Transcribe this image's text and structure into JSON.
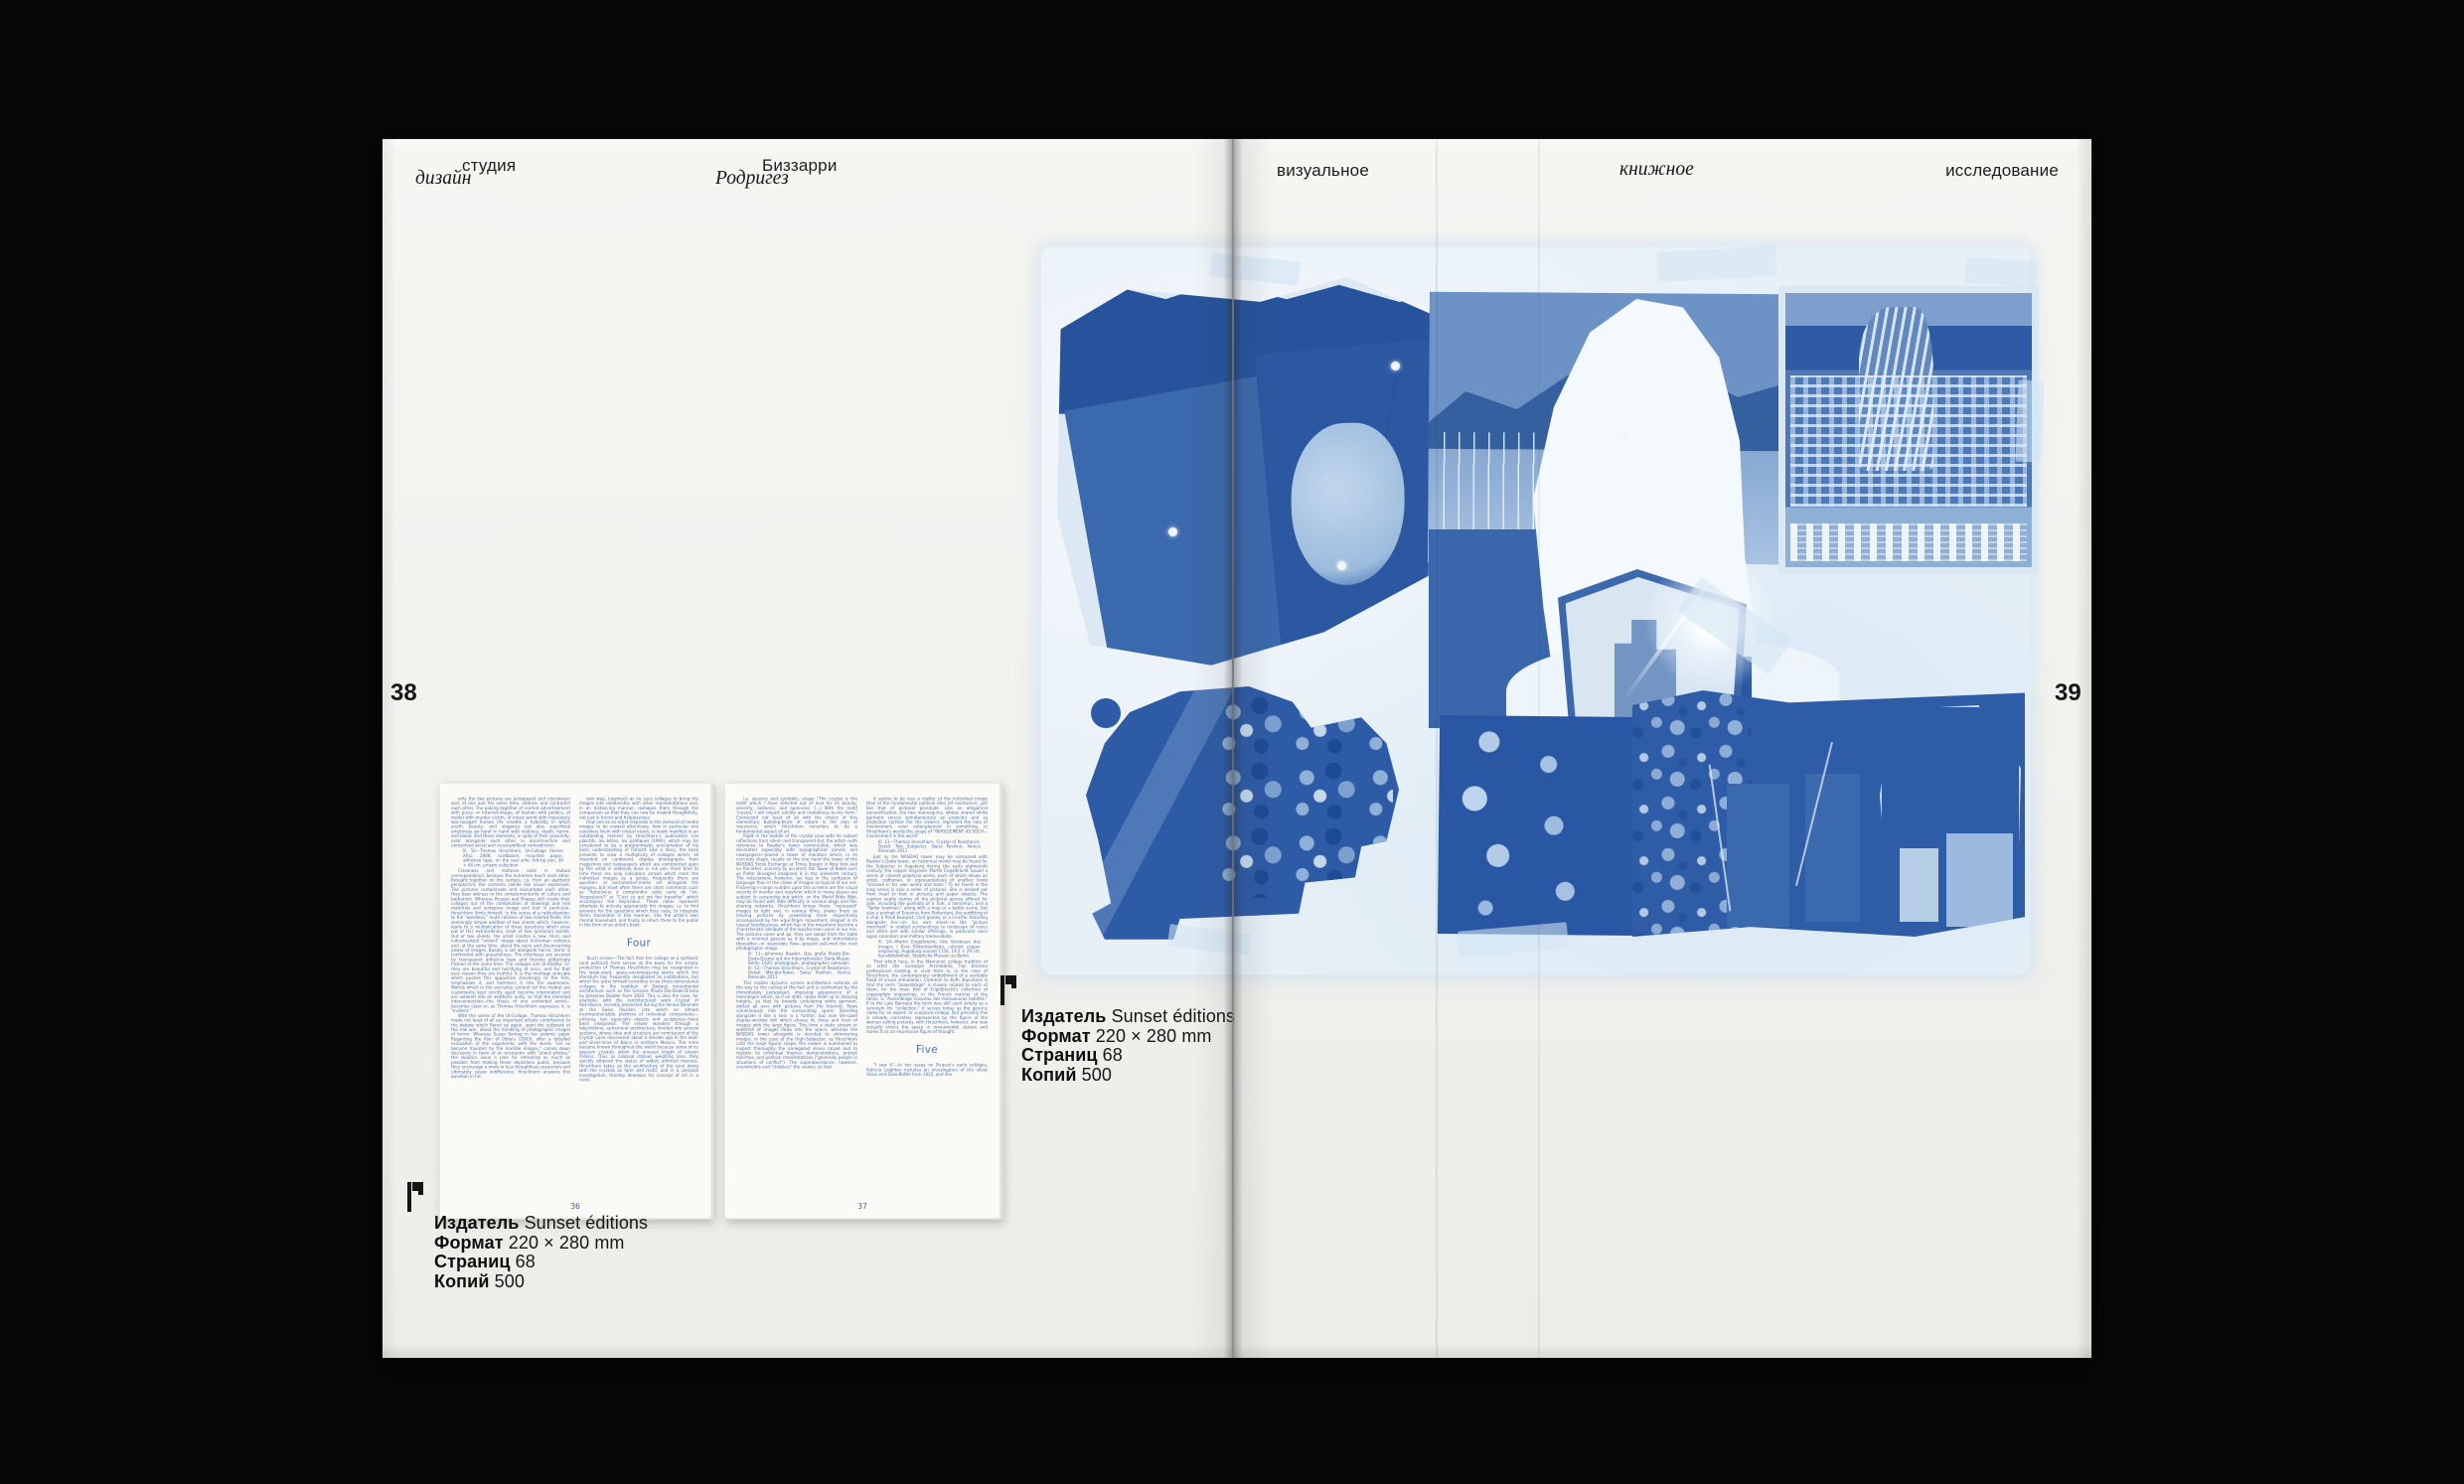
{
  "colors": {
    "background": "#070707",
    "paper": "#f2f1ee",
    "cyanotype_mid": "#3f6cac",
    "cyanotype_dark": "#2a57a3",
    "cyanotype_pale": "#e7f0f7",
    "mini_text_blue": "#4b70a9"
  },
  "icons": {
    "colophon_mark": "flag-pennant"
  },
  "left_header": {
    "studio_word": "студия",
    "design_word": "дизайн",
    "name_word1": "Биззарри",
    "name_word2": "Родригез"
  },
  "right_header": {
    "word1": "визуальное",
    "word2": "книжное",
    "word3": "исследование"
  },
  "page_numbers": {
    "left": "38",
    "right": "39"
  },
  "colophon": {
    "lines": [
      {
        "label": "Издатель",
        "value": "Sunset éditions"
      },
      {
        "label": "Формат",
        "value": "220 × 280 mm"
      },
      {
        "label": "Страниц",
        "value": "68"
      },
      {
        "label": "Копий",
        "value": "500"
      }
    ]
  },
  "mini_pages": [
    {
      "number": "36",
      "col1": [
        {
          "type": "para",
          "text": "only the two pictures are juxtaposed and interwoven and, at one and the same time, address and contradict each other. The poking together of current advertisement with press- or Internet-image, of fashion with politics, of model with murder victim, of intact world with hopelessly war-ravaged human life creates a hybridity in which youth, beauty, and elegance but also superficial emptiness go hand in hand with violence, death, horror, and blood, and these elements, in spite of their proximity, exist alongside each other in disconnection and unresolved social and visual-political contradiction."
        },
        {
          "type": "caption",
          "text": "Ill. 10—Thomas Hirschhorn, Ut-Collage (Series XXL), 2008, cardboard, mounted paper, adhesive tape, on the rear side: felt-tip pen, 30 × 44 cm, private collection"
        },
        {
          "type": "para",
          "text": "Closeness and distance exist in mutual correspondence, because the extremes touch each other. Brought together on the surface, i.e. from an aesthetic perspective, the contents collide like visual explosives. The pictures contaminate and exacerbate each other, they bear witness to the complementarity of culture and barbarism. Whereas Picasso and Braque still create their collages out of the combination of drawings and real materials and juxtapose image and text in particular, Hirschhorn limits himself, in the sense of a radicalization, to the \"wordless,\" mute collision of two colored fields, the seemingly simple addition of two sheets which, however, leads to a multiplication of those questions which arise out of this extraordinary clash of two (pictorial) worlds. Out of two sheets, the artist creates a new, third, and individualized \"violent\" image about (in)human violence and, at the same time, about the eerie and disconcerting power of images. Beauty is set alongside horror, terror is confronted with gracefulness. The interfaces are secured by transparent adhesive tape and thereby glitteringly framed at the same time. The collages aim at totality: i.e. they are beautiful and horrifying at once, and for that very reason they are truthful. It is the montage principle which pushes this opposition shockingly to the fore, emphasizes it, and hammers it into the awareness. Worlds which in the everyday context (of the media) are customarily kept strictly apart become interrelated and are ushered into an aesthetic unity, so that the intended interconnection—the thesis of one undivided world—becomes clear or, as Thomas Hirschhorn expresses it, is \"evident.\""
        },
        {
          "type": "para",
          "text": "With the series of the Ut-Collage, Thomas Hirschhorn made not least of all an important artistic contribution to the debate which flared up again, upon the outbreak of the Irak war, about the handling of photographic images of horror. Whereas Susan Sontag in her polemic paper Regarding the Pain of Others (2003), after a detailed evaluation of the arguments, with the words \"Let us become haunted by the horrible images,\" comes down decisively in favor of an encounter with \"shock photos,\" the skeptics issue a plea for refraining as much as possible from making these depictions public, because they encourage a more or less thoughtless voyeurism and ultimately cause indifference. Hirschhorn answers this question in his"
        }
      ],
      "col2": [
        {
          "type": "para",
          "text": "own way, inasmuch as he uses collages to bring the images into relationship with other representations and, in an distancing manner, reshapes them through the comparison so that they can now be viewed thoughtfully, not just in horror and helplessness."
        },
        {
          "type": "para",
          "text": "How one as an artist responds to the demand of media images to be viewed attentively, how in particular one considers them with critical vision, is made manifest in an outstanding manner by Hirschhorn's publication Les plaintifs, les bêtes, les politiques (1995), which may be considered to be a programmatic proclamation of his basic understanding of himself. Like a diary, the book presents to view a multiplicity of collages which, all mounted on cardboard, display photographs from magazines and newspapers which are commented upon by the artist in addenda done in ink pen. From time to time there are only indicatory arrows which mark the individual images as a group, frequently there are question- or exclamation-marks set alongside the margins, but most often there are short comments such as \"Autorisé-je à comprendre cette carte de l'ex-Yougoslavie?\" or \"C'est ce qui me fait travailler\" which accompany the depictions. These notes represent attempts to actively appropriate the images, i.e. to find answers for the questions which they raise, to integrate them, translated in this manner, into the artist's own mental household, and finally to return them to the public in the form of an artist's book."
        },
        {
          "type": "heading",
          "text": "Four"
        },
        {
          "type": "para",
          "text": "Touch screen—The fact that the collage as a symbolic (and political) form serves as the basis for the artistic production of Thomas Hirschhorn may be recognized in the large-sized, space-encompassing works which the literature has frequently designated as installations, but which the artist himself considers to be three-dimensional collages in the tradition of Dadaist monumental architecture such as the Grosses Plasto-Dio-Dada-Drama by Johannes Baader from 1920. This is also the case, for example, with the (architectural) work Crystal of Resistance, recently presented during the Venice Biennale at the Swiss Pavilion, into which an almost incomprehensible plethora of individual components—pictures, but especially objects and sculptures—have been integrated. The viewer wanders through a labyrinthine, ephemeral architecture, divided into several sections, whose idea and structure are reminiscent of the Crystal Cave discovered about a decade ago in the lead- and silver-mine of Naica in northern Mexico. The mine became known throughout the world because some of its gypsum crystals attain the unusual length of eleven meters. Thus as colossal statues weighing tons, they quickly attained the status of widely admired marvels. Hirschhorn takes up the architecture of the cave along with the crystals as form and motif, and in a complex investigation, thereby develops his concept of art in a vivid,"
        }
      ]
    },
    {
      "number": "37",
      "col1": [
        {
          "type": "para",
          "text": "i.e. sensory and symbolic, shape \"The crystal is the motif which I have selected out of love for its beauty, severity, radiance, and openness. [...] With the motif 'crystal,' I will impart solidity and rootedness to my form.\" Connected not least of all with the choice of this elementary building-block of nature is the idea of resistance, which Hirschhorn considers to be a fundamental aspect of art."
        },
        {
          "type": "para",
          "text": "Right in the middle of the crystal cave with its radiant reflections from silver- and transparent-foil, the artist—with reference to Baader's tower construction, which was decorated especially with typographical panels and newspapers—placed a tower of monitors which, in its concrete shape, recalls on the one hand the tower of the NASDAQ Stock Exchange at Times Square in New York and on the other, scarcely by accident, the Tower of Babel such as Pieter Brueghel imagined it in the sixteenth century. The inducement, however, lay less in the confusion of language than in the chaos of images so typical of our era. Flickering in large number upon the screens are the visual records of murder and mayhem which in many places are subject to censorship but which, on the World Wide Web, may be found with little difficulty in various blogs and file-sharing networks. Hirschhorn brings these \"repressed\" images to light and, in various films, shows them as moving pictures by presenting them respectively accompanied by the wipe-finger movement, elegant in its casual heedlessness, which has in the meantime become a characteristic attribute of the touchscreen-users in our era. The pictures come and go, they are swept from the table with a minimal gesture as if by magic, and immediately thereafter—in inexorable flow—present pell-mell the next photographic image."
        },
        {
          "type": "caption",
          "text": "Ill. 11—Johannes Baader, Das große Plasto-Dio-Dada-Drama auf der Internationalen Dada-Messe, Berlin 1920, photograph, photographer unknown. Ill. 12—Thomas Hirschhorn, Crystal of Resistance, Detail: Monitor-Tower, Swiss Pavilion, Venice Biennale 2011"
        },
        {
          "type": "para",
          "text": "This mobile dynamic screen architecture extends all the way to the ceiling of the hall and is confronted by the immediately juxtaposed, imposing appearance of a mannequin which, as if on stilts, raises itself up to dizzying heights, so that its broadly undulating white garment, dotted all over with pictures from the Internet, flows voluminously into the surrounding space. Standing alongside it like a twin is a further, but now life-sized display-window doll which shares its dress and train of images with the large figure. This time a static stream or waterfall of images flows into the space, whereas the NASDAQ tower alongside is devoted to shimmering images. In the case of the High-Subjecter, as Hirschhorn calls the large figural shape, the viewer is summoned to inspect thoroughly the variegated visual carpet and to register its individual themes: demonstrations, protest marches, and political manifestations (\"generally people in situations of conflict\"). The superabundance, however, overwhelms and \"clobbers\" the viewer, so that"
        }
      ],
      "col2": [
        {
          "type": "para",
          "text": "it seems to be less a matter of the individual image than of the fundamental political idea (of resistance), just like that of pictorial plenitude. Like an allegorical personification, the two mannequins, whose shared white garment serves simultaneously as projector and as projection surface (for the viewer), represent the idea of involvement, even entanglement in something, in Hirschhorn's words the shape of \"INVOLVEMENT AS SUCH—involvement in the world\""
        },
        {
          "type": "caption",
          "text": "Ill. 13—Thomas Hirschhorn, Crystal of Resistance, Detail: Two Subjecter, Swiss Pavilion, Venice Biennale 2011"
        },
        {
          "type": "para",
          "text": "Just as the NASDAQ tower may be compared with Baader's Dada tower, an historical model may be found for the Subjecter in Augsburg during the early eighteenth century: the copper engraver Martin Engelbrecht issued a series of colored graphical works, each of which shows an artist, craftsman, or representatives of another trade \"dressed in his own works and tools.\" To be found in the long series is also a seller of pictures. She is decked out from head to foot in pictures and paper objects. The caption neatly names all the pictorial genres offered for sale, including the portraits of a Turk, a horseman, and a \"Tartar bowman,\" along with a map or a battle scene, but also a portrait of Erasmus from Rotterdam, the outfitting of a ship, a floral bouquet, card games, or a crucifix. Standing alongside her—on his own sheet—is the \"picture merchant\" in related surroundings (a landscape of ruins) and attire and with similar offerings, in particular once again calendars and military memorabilia."
        },
        {
          "type": "caption",
          "text": "Ill. 14—Martin Engelbrecht, Une Vendeuse des Images / Eine Bilderhändlerin, colored copper engraving, Augsburg around 1730, 19.5 × 29 cm, Kunstbibliothek, Staatliche Museen zu Berlin."
        },
        {
          "type": "para",
          "text": "That which here, in the Mannerist collage tradition of an artist like Guiseppe Arcimboldo, has become professional clothing in vivid form is, in the case of Hirschhorn, the contemporary embodiment of a veritable flood of visual stimulation. Common to both depictions is that the term \"assemblage\" is closely related to each of them, for the main title of Engelbrecht's collection of copperplate engravings, in the French manner of the times, is \"Assemblage nouveau des manoeuvres habillés.\" If in the Late Baroque the term was still used simply as a synonym for \"collection,\" it serves today as the generic name for an object- or sculpture-collage. But precisely this is already concretely represented by the figure of the woman selling pictures, with Hirschhorn, however, she now actually enters the space in monumental stature and marks it as an impressive figure of thought."
        },
        {
          "type": "heading",
          "text": "Five"
        },
        {
          "type": "para",
          "text": "\"I saw it\"—In her essay on Picasso's early collages, Patricia Leighten includes an investigation of the sheet Glass and Suze-Bottle from 1922, and she"
        }
      ]
    }
  ]
}
